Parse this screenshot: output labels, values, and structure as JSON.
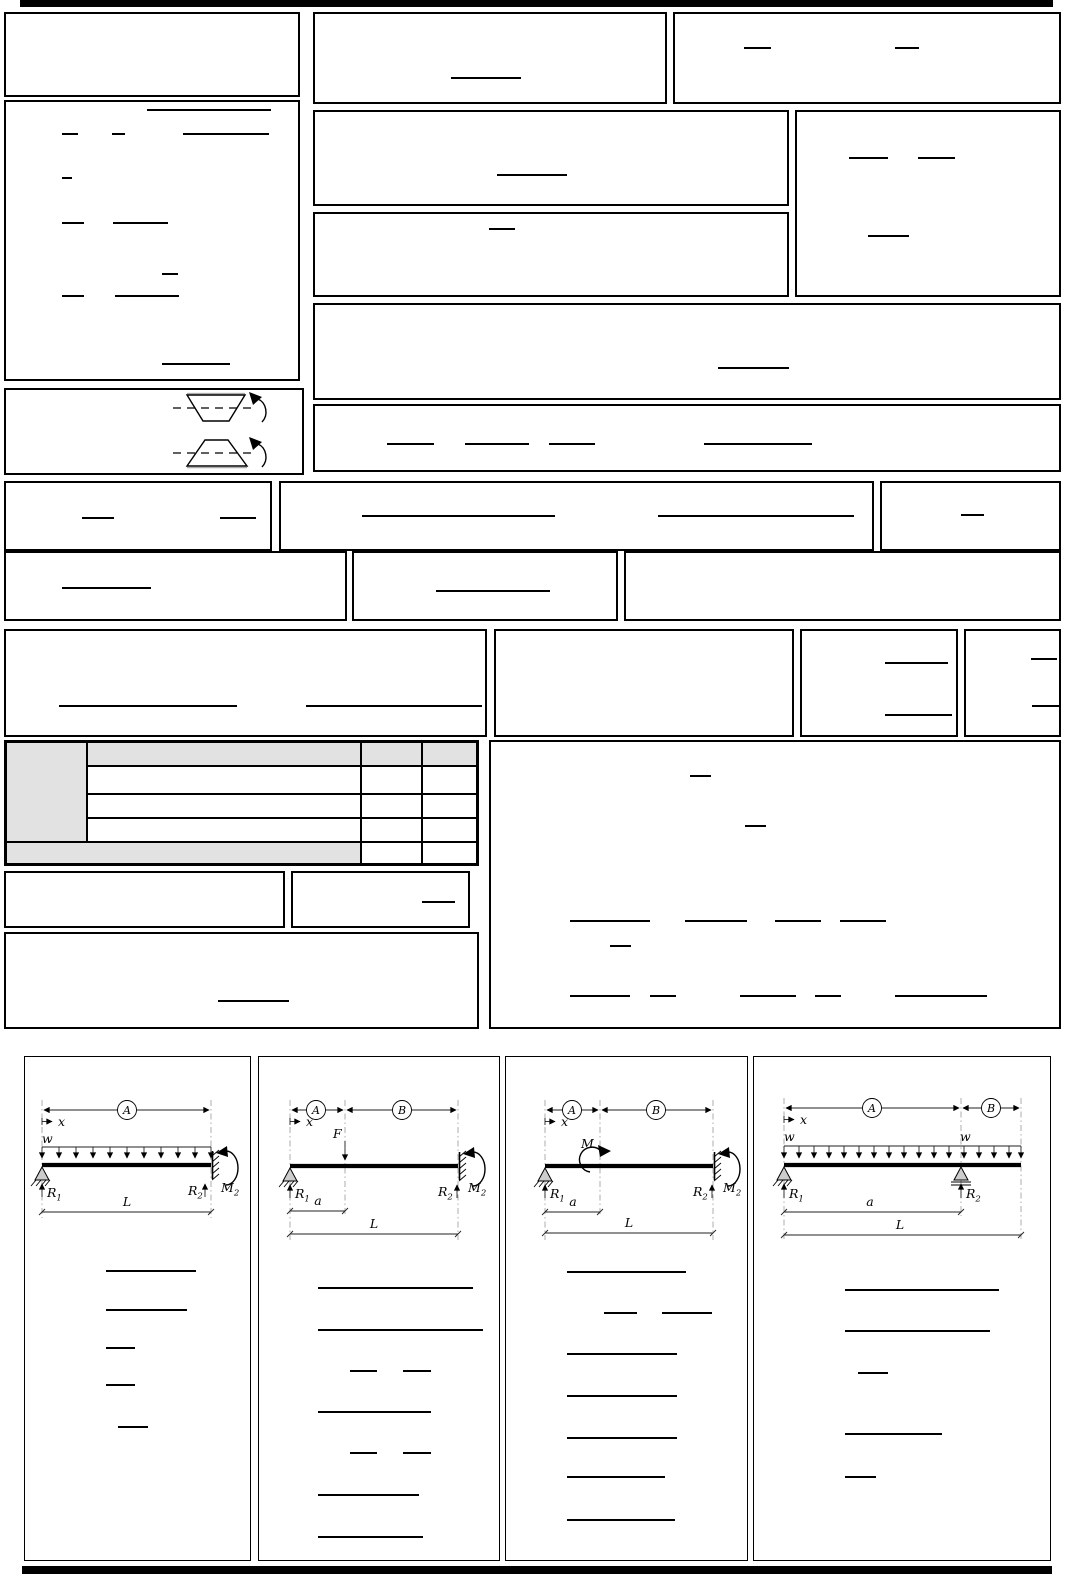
{
  "document": {
    "kind": "beam-formula-reference-sheet"
  },
  "colors": {
    "ink": "#000000",
    "table_gray": "#e2e2e2",
    "extension_line": "#999999",
    "support_fill": "#cccccc"
  },
  "sym": {
    "A": "A",
    "B": "B",
    "x": "x",
    "w": "w",
    "F": "F",
    "M": "M",
    "L": "L",
    "a": "a",
    "R": "R",
    "sub1": "1",
    "sub2": "2"
  },
  "beam_panels": [
    {
      "id": 1,
      "supports": "pin-left fixed-right",
      "load": "uniform w over full span",
      "span_labels": [
        "A"
      ],
      "reaction_labels": [
        "R1",
        "R2",
        "M2"
      ],
      "dimension_labels": [
        "x",
        "L"
      ]
    },
    {
      "id": 2,
      "supports": "pin-left fixed-right",
      "load": "point force F at distance a",
      "span_labels": [
        "A",
        "B"
      ],
      "reaction_labels": [
        "R1",
        "R2",
        "M2"
      ],
      "dimension_labels": [
        "x",
        "a",
        "L"
      ]
    },
    {
      "id": 3,
      "supports": "pin-left fixed-right",
      "load": "applied moment M at distance a",
      "span_labels": [
        "A",
        "B"
      ],
      "reaction_labels": [
        "R1",
        "R2",
        "M2"
      ],
      "dimension_labels": [
        "x",
        "a",
        "L"
      ]
    },
    {
      "id": 4,
      "supports": "pin-left roller at a with overhang",
      "load": "uniform w over full length",
      "span_labels": [
        "A",
        "B"
      ],
      "reaction_labels": [
        "R1",
        "R2"
      ],
      "dimension_labels": [
        "x",
        "w",
        "a",
        "L"
      ]
    }
  ],
  "section_figures": [
    {
      "shape": "trapezoid-inverted",
      "has_dashed_axis": true,
      "has_rotation_arrow": true
    },
    {
      "shape": "trapezoid-upright",
      "has_dashed_axis": true,
      "has_rotation_arrow": true
    }
  ],
  "table": {
    "rows": 5,
    "cols": 4,
    "gray_cells": "left column, header row, bottom-left span"
  },
  "formula_rules": [
    [
      451,
      77,
      70
    ],
    [
      744,
      47,
      27
    ],
    [
      895,
      47,
      24
    ],
    [
      849,
      157,
      39
    ],
    [
      918,
      157,
      37
    ],
    [
      868,
      235,
      41
    ],
    [
      147,
      109,
      124
    ],
    [
      62,
      133,
      16
    ],
    [
      112,
      133,
      13
    ],
    [
      183,
      133,
      86
    ],
    [
      62,
      177,
      10
    ],
    [
      62,
      222,
      22
    ],
    [
      113,
      222,
      55
    ],
    [
      162,
      273,
      16
    ],
    [
      62,
      295,
      22
    ],
    [
      115,
      295,
      64
    ],
    [
      162,
      363,
      68
    ],
    [
      497,
      174,
      70
    ],
    [
      489,
      228,
      26
    ],
    [
      718,
      367,
      71
    ],
    [
      387,
      443,
      47
    ],
    [
      465,
      443,
      64
    ],
    [
      549,
      443,
      46
    ],
    [
      704,
      443,
      108
    ],
    [
      82,
      517,
      32
    ],
    [
      220,
      517,
      36
    ],
    [
      362,
      515,
      193
    ],
    [
      658,
      515,
      196
    ],
    [
      961,
      514,
      23
    ],
    [
      62,
      587,
      89
    ],
    [
      436,
      590,
      114
    ],
    [
      59,
      705,
      178
    ],
    [
      306,
      705,
      176
    ],
    [
      885,
      662,
      63
    ],
    [
      885,
      714,
      67
    ],
    [
      1031,
      658,
      26
    ],
    [
      1032,
      705,
      28
    ],
    [
      422,
      901,
      33
    ],
    [
      218,
      1000,
      71
    ],
    [
      690,
      775,
      21
    ],
    [
      745,
      825,
      21
    ],
    [
      570,
      920,
      80
    ],
    [
      685,
      920,
      62
    ],
    [
      775,
      920,
      46
    ],
    [
      840,
      920,
      46
    ],
    [
      610,
      945,
      21
    ],
    [
      570,
      995,
      60
    ],
    [
      650,
      995,
      26
    ],
    [
      740,
      995,
      56
    ],
    [
      815,
      995,
      26
    ],
    [
      895,
      995,
      92
    ],
    [
      106,
      1270,
      90
    ],
    [
      106,
      1309,
      81
    ],
    [
      106,
      1347,
      29
    ],
    [
      106,
      1384,
      29
    ],
    [
      118,
      1426,
      30
    ],
    [
      318,
      1287,
      155
    ],
    [
      318,
      1329,
      165
    ],
    [
      350,
      1370,
      27
    ],
    [
      403,
      1370,
      28
    ],
    [
      318,
      1411,
      113
    ],
    [
      350,
      1452,
      27
    ],
    [
      403,
      1452,
      28
    ],
    [
      318,
      1494,
      101
    ],
    [
      318,
      1536,
      105
    ],
    [
      567,
      1271,
      119
    ],
    [
      604,
      1312,
      33
    ],
    [
      662,
      1312,
      50
    ],
    [
      567,
      1353,
      110
    ],
    [
      567,
      1395,
      110
    ],
    [
      567,
      1437,
      110
    ],
    [
      567,
      1476,
      98
    ],
    [
      567,
      1519,
      108
    ],
    [
      845,
      1289,
      154
    ],
    [
      845,
      1330,
      145
    ],
    [
      858,
      1372,
      30
    ],
    [
      845,
      1433,
      97
    ],
    [
      845,
      1476,
      31
    ]
  ]
}
